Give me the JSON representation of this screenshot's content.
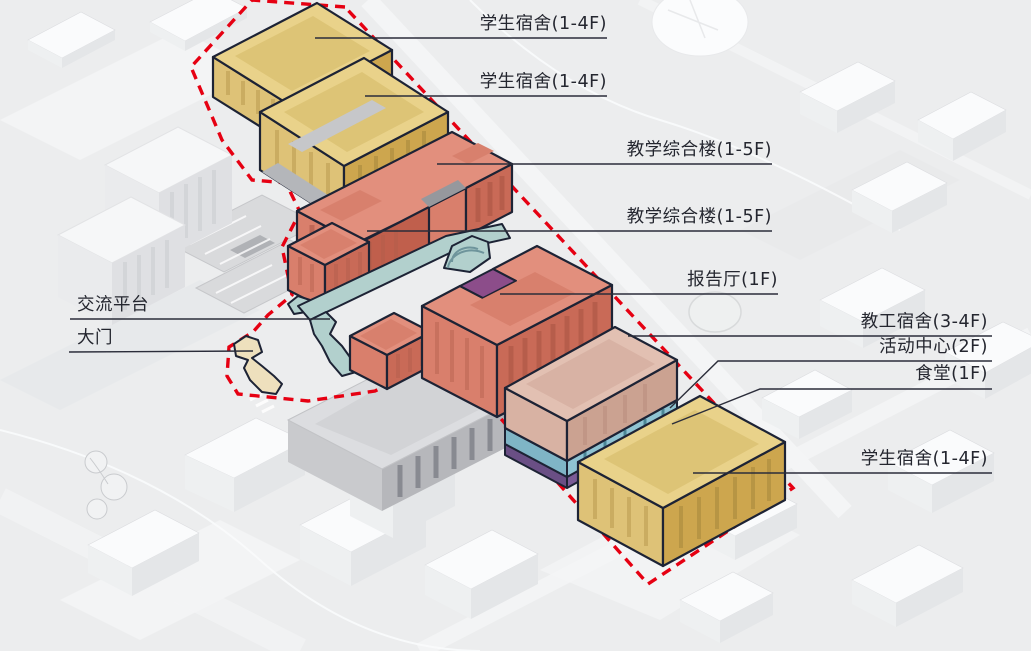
{
  "diagram": {
    "labels": [
      {
        "id": "student-dorm-1",
        "text": "学生宿舍(1-4F)"
      },
      {
        "id": "student-dorm-2",
        "text": "学生宿舍(1-4F)"
      },
      {
        "id": "teaching-complex-1",
        "text": "教学综合楼(1-5F)"
      },
      {
        "id": "teaching-complex-2",
        "text": "教学综合楼(1-5F)"
      },
      {
        "id": "lecture-hall",
        "text": "报告厅(1F)"
      },
      {
        "id": "staff-dorm",
        "text": "教工宿舍(3-4F)"
      },
      {
        "id": "activity-center",
        "text": "活动中心(2F)"
      },
      {
        "id": "canteen",
        "text": "食堂(1F)"
      },
      {
        "id": "student-dorm-3",
        "text": "学生宿舍(1-4F)"
      },
      {
        "id": "exchange-platform",
        "text": "交流平台"
      },
      {
        "id": "main-gate",
        "text": "大门"
      }
    ],
    "colors": {
      "student_dorm_yellow": "#e9d28a",
      "teaching_salmon": "#e28f7d",
      "staff_dorm_pink": "#e2c0b2",
      "activity_center_teal": "#8fc3d2",
      "canteen_purple": "#7a5b96",
      "lecture_hall_purple": "#8c4d8a",
      "platform_teal": "#b2d0cd",
      "gate_cream": "#eee0bd",
      "site_boundary_red": "#e60012",
      "outline_navy": "#1d2335",
      "label_text": "#24262f"
    }
  }
}
